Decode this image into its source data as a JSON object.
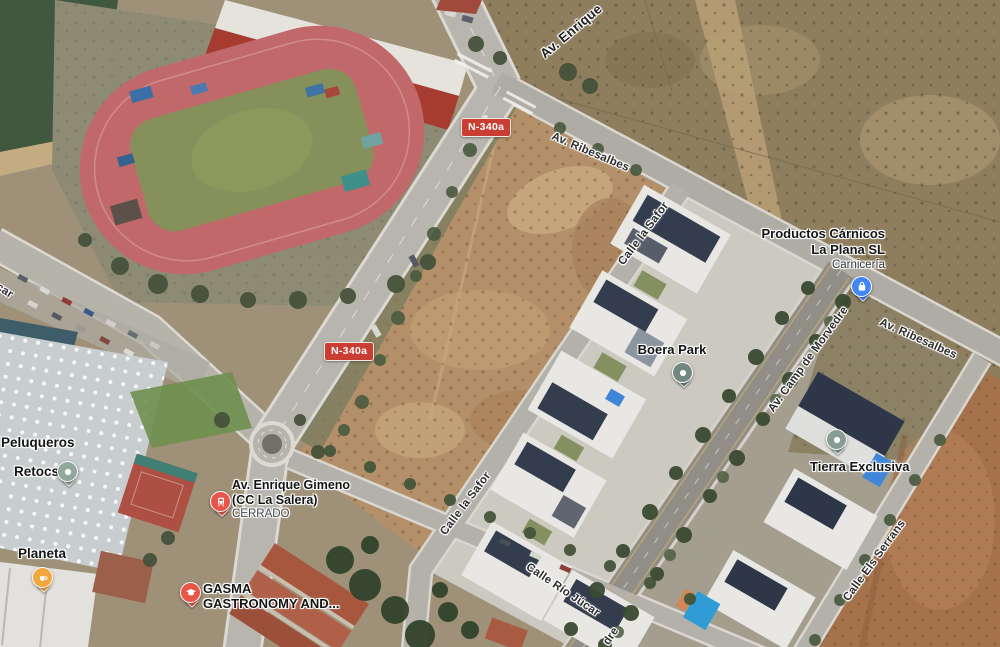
{
  "map": {
    "view": "satellite"
  },
  "badges": {
    "n340a_1": "N-340a",
    "n340a_2": "N-340a"
  },
  "streets": {
    "av_enrique": "Av. Enrique",
    "av_ribesalbes_1": "Av. Ribesalbes",
    "av_ribesalbes_2": "Av. Ribesalbes",
    "calle_la_safor_1": "Calle la Safor",
    "calle_la_safor_2": "Calle la Safor",
    "av_camp_de_morvedre": "Av. Camp de Morvedre",
    "calle_rio_jucar": "Calle Río Júcar",
    "calle_els_serrans": "Calle Els Serrans",
    "partial_left": "car",
    "partial_bottom": "dre"
  },
  "pois": {
    "productos_carnicos": {
      "line1": "Productos Cárnicos",
      "line2": "La Plana SL",
      "subtitle": "Carnicería",
      "icon": "shopping-bag",
      "color": "#4285f4"
    },
    "boera_park": {
      "line1": "Boera Park",
      "icon": "place-dot",
      "color": "#72877f"
    },
    "tierra_exclusiva": {
      "line1": "Tierra Exclusiva",
      "icon": "place-dot",
      "color": "#879d94"
    },
    "peluqueros_retocs": {
      "line1": "Peluqueros",
      "line2": "Retocs",
      "icon": "place-dot",
      "color": "#90a89c"
    },
    "planeta": {
      "line1": "Planeta",
      "icon": "coffee-cup",
      "color": "#efa73e"
    },
    "cc_la_salera": {
      "line1": "Av. Enrique Gimeno",
      "line2": "(CC La Salera)",
      "status": "CERRADO",
      "icon": "train",
      "color": "#e8564a"
    },
    "gasma": {
      "line1": "GASMA",
      "line2": "GASTRONOMY AND...",
      "icon": "graduation-cap",
      "color": "#e8564a"
    }
  }
}
